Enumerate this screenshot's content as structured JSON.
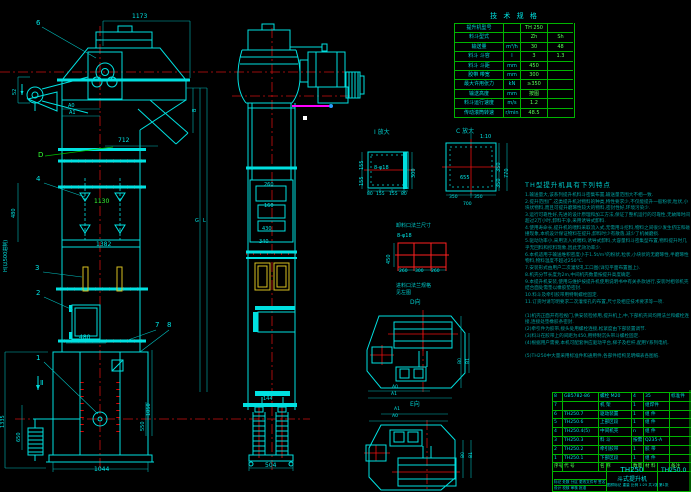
{
  "colors": {
    "background": "#000000",
    "line_cyan": "#00e0e0",
    "dim_cyan": "#00b8b8",
    "centerline_red": "#ff2020",
    "grid_green": "#00b400",
    "text_green": "#5aff5a",
    "note_teal": "#00a0a0",
    "bucket_yellow": "#d8c020",
    "magenta": "#ff00ff"
  },
  "spec": {
    "title": "技 术 规 格",
    "rows": [
      [
        "提升机型号",
        "",
        "TH 250",
        ""
      ],
      [
        "料斗型式",
        "",
        "Zh",
        "Sh"
      ],
      [
        "输送量",
        "m³/h",
        "30",
        "48"
      ],
      [
        "料斗 斗容",
        "l",
        "3",
        "1.3"
      ],
      [
        "料斗 斗距",
        "mm",
        "450",
        ""
      ],
      [
        "胶带 带宽",
        "mm",
        "300",
        ""
      ],
      [
        "最大许用张力",
        "kN",
        "≥350",
        ""
      ],
      [
        "输送高度",
        "mm",
        "按图",
        ""
      ],
      [
        "料斗运行速度",
        "m/s",
        "1.2",
        ""
      ],
      [
        "传动滚筒转速",
        "r/min",
        "48.5",
        ""
      ]
    ]
  },
  "notes": {
    "title": "TH型提升机具有下列特点",
    "lines": [
      "1.输送量大,该系列提升机料斗密集布置,输送量范围大不相一致.",
      "2.提升范围广,这类提升机对物料的种类,特性要求少,不仅能提升一般粉状,粒状,小块状物料,而且可提升磨琢性较大的物料,密封性好,环境污染少.",
      "3.运行可靠性好,先进的设计原理和加工方法,保证了整机运行的可靠性,无故障时间超过2万小时,卸料干净,采用诱导式卸料.",
      "4.使用寿命长,提升机的喂料采取流入式,无需用斗挖料,物料之间很少发生挤压和碰撞现象,本机设计保证物料在提升,卸料时少有散落,减少了机械磨损.",
      "5.驱动功率小,采用流入式喂料,诱导式卸料,大容量料斗密集型布置,物料提升时几乎无回料和挖料现象,因此无效功率少.",
      "6.本机适用于输送堆积密度小于1.5t/m³的粉状,粒状,小块状的无磨琢性,半磨琢性物料,物料温度不超过250℃.",
      "7.安装形式由用户二次灌浆孔工口图(详见平面布置图上).",
      "8.机壳分节长度为2m,中间机壳数量按提升高度确定.",
      "9.本提升机安装,使用与维护按提升机使用说明书中有关条款进行,安装时相邻机壳结合面处需垫以橡胶垫密封.",
      "10.料斗及牵引胶带用特制螺栓固定.",
      "11.订货时请写明要求二次灌浆孔的布置,尺寸及相应技术要求等一项.",
      "",
      "(1)机壳正面开有检视门,供安装检修用,提升机上,中,下部机壳间均用法兰和螺栓连接,连接处垫橡胶条密封.",
      "(2)牵引件为胶带,接头处用螺栓连接,松紧度由下部装置调节.",
      "(3)料斗在胶带上的间距为450,用特制沉头带斗螺栓固定.",
      "(4)根据用户需要,本机可配套供应驱动平台,梯子及栏杆,配用Y系列电机.",
      "",
      "(5)TH250中大量采用标准件和通用件,各部件结构见明细表各图纸."
    ]
  },
  "bom": {
    "header": [
      "序号",
      "代  号",
      "名  称",
      "数量",
      "材  料",
      "备注"
    ],
    "rows": [
      {
        "no": "8",
        "code": "GB5782-86",
        "name": "螺栓 M20",
        "qty": "4",
        "mat": "35",
        "note": "标准件"
      },
      {
        "no": "7",
        "code": "",
        "name": "机 架",
        "qty": "1",
        "mat": "组焊件",
        "note": ""
      },
      {
        "no": "6",
        "code": "TH250.7",
        "name": "驱动装置",
        "qty": "1",
        "mat": "组 件",
        "note": ""
      },
      {
        "no": "5",
        "code": "TH250.6",
        "name": "上部区段",
        "qty": "1",
        "mat": "组 件",
        "note": ""
      },
      {
        "no": "4",
        "code": "TH250.4(5)",
        "name": "中间机壳",
        "qty": "n",
        "mat": "组 件",
        "note": ""
      },
      {
        "no": "3",
        "code": "TH250.3",
        "name": "料 斗",
        "qty": "按需",
        "mat": "Q235-A",
        "note": ""
      },
      {
        "no": "2",
        "code": "TH250.2",
        "name": "牵引胶带",
        "qty": "1",
        "mat": "胶 带",
        "note": ""
      },
      {
        "no": "1",
        "code": "TH250.1",
        "name": "下部区段",
        "qty": "1",
        "mat": "组 件",
        "note": ""
      }
    ]
  },
  "title_block": {
    "model": "TH250",
    "product": "斗式提升机",
    "drawing_no": "TH250.0",
    "sig_row1": "标记 处数 分区 更改文件号 签名 日期",
    "sig_row2": "设计   校核   审核   批准",
    "scale_row": "图样标记    重量    比例 1:25    共1张 第1张"
  },
  "labels": [
    {
      "t": "1173",
      "x": 132,
      "y": 14,
      "c": "#00e5e5",
      "s": 6,
      "r": 0
    },
    {
      "t": "712",
      "x": 118,
      "y": 138,
      "c": "#00e5e5",
      "s": 6,
      "r": 0
    },
    {
      "t": "A0",
      "x": 68,
      "y": 104,
      "c": "#00e5e5",
      "s": 5,
      "r": 0
    },
    {
      "t": "A1",
      "x": 69,
      "y": 111,
      "c": "#00e5e5",
      "s": 5,
      "r": 0
    },
    {
      "t": "52",
      "x": 13,
      "y": 95,
      "c": "#00e5e5",
      "s": 5,
      "r": -90
    },
    {
      "t": "6",
      "x": 36,
      "y": 20,
      "c": "#00e5e5",
      "s": 7,
      "r": 0
    },
    {
      "t": "D",
      "x": 38,
      "y": 152,
      "c": "#33ff33",
      "s": 7,
      "r": 0
    },
    {
      "t": "4",
      "x": 36,
      "y": 176,
      "c": "#00e5e5",
      "s": 7,
      "r": 0
    },
    {
      "t": "480",
      "x": 12,
      "y": 218,
      "c": "#00e5e5",
      "s": 5,
      "r": -90
    },
    {
      "t": "1130",
      "x": 94,
      "y": 199,
      "c": "#33ff33",
      "s": 6,
      "r": 0
    },
    {
      "t": "1382",
      "x": 96,
      "y": 242,
      "c": "#00e5e5",
      "s": 6,
      "r": 0
    },
    {
      "t": "H(以500进制)",
      "x": 4,
      "y": 272,
      "c": "#00e5e5",
      "s": 5,
      "r": -90
    },
    {
      "t": "3",
      "x": 35,
      "y": 265,
      "c": "#00e5e5",
      "s": 7,
      "r": 0
    },
    {
      "t": "2",
      "x": 36,
      "y": 290,
      "c": "#00e5e5",
      "s": 7,
      "r": 0
    },
    {
      "t": "G",
      "x": 195,
      "y": 219,
      "c": "#00e5e5",
      "s": 5,
      "r": 0
    },
    {
      "t": "L",
      "x": 203,
      "y": 219,
      "c": "#00e5e5",
      "s": 5,
      "r": 0
    },
    {
      "t": "7",
      "x": 155,
      "y": 322,
      "c": "#00e5e5",
      "s": 7,
      "r": 0
    },
    {
      "t": "8",
      "x": 167,
      "y": 322,
      "c": "#00e5e5",
      "s": 7,
      "r": 0
    },
    {
      "t": "1",
      "x": 36,
      "y": 355,
      "c": "#00e5e5",
      "s": 7,
      "r": 0
    },
    {
      "t": "480",
      "x": 79,
      "y": 335,
      "c": "#00e5e5",
      "s": 6,
      "r": 0
    },
    {
      "t": "Ⅱ",
      "x": 40,
      "y": 380,
      "c": "#00e5e5",
      "s": 7,
      "r": 0
    },
    {
      "t": "1335",
      "x": 1,
      "y": 428,
      "c": "#00e5e5",
      "s": 5,
      "r": -90
    },
    {
      "t": "650",
      "x": 17,
      "y": 442,
      "c": "#00e5e5",
      "s": 5,
      "r": -90
    },
    {
      "t": "1050",
      "x": 147,
      "y": 416,
      "c": "#00e5e5",
      "s": 5,
      "r": -90
    },
    {
      "t": "550",
      "x": 141,
      "y": 431,
      "c": "#00e5e5",
      "s": 5,
      "r": -90
    },
    {
      "t": "1044",
      "x": 94,
      "y": 467,
      "c": "#00e5e5",
      "s": 6,
      "r": 0
    },
    {
      "t": "B",
      "x": 193,
      "y": 112,
      "c": "#00e5e5",
      "s": 5,
      "r": -90
    },
    {
      "t": "260",
      "x": 264,
      "y": 183,
      "c": "#00e5e5",
      "s": 5,
      "r": 0
    },
    {
      "t": "160",
      "x": 264,
      "y": 204,
      "c": "#00e5e5",
      "s": 5,
      "r": 0
    },
    {
      "t": "430",
      "x": 262,
      "y": 227,
      "c": "#00e5e5",
      "s": 5,
      "r": 0
    },
    {
      "t": "340",
      "x": 259,
      "y": 240,
      "c": "#00e5e5",
      "s": 5,
      "r": 0
    },
    {
      "t": "144",
      "x": 263,
      "y": 397,
      "c": "#00e5e5",
      "s": 5,
      "r": 0
    },
    {
      "t": "504",
      "x": 265,
      "y": 463,
      "c": "#00e5e5",
      "s": 6,
      "r": 0
    },
    {
      "t": "Ⅰ 放大",
      "x": 374,
      "y": 130,
      "c": "#00cccc",
      "s": 6,
      "r": 0
    },
    {
      "t": "155",
      "x": 360,
      "y": 170,
      "c": "#00e5e5",
      "s": 5,
      "r": -90
    },
    {
      "t": "155",
      "x": 360,
      "y": 186,
      "c": "#00e5e5",
      "s": 5,
      "r": -90
    },
    {
      "t": "300",
      "x": 412,
      "y": 178,
      "c": "#00e5e5",
      "s": 5,
      "r": -90
    },
    {
      "t": "8-φ18",
      "x": 374,
      "y": 166,
      "c": "#00e5e5",
      "s": 5,
      "r": 0
    },
    {
      "t": "80",
      "x": 367,
      "y": 193,
      "c": "#00e5e5",
      "s": 4.5,
      "r": 0
    },
    {
      "t": "155",
      "x": 376,
      "y": 193,
      "c": "#00e5e5",
      "s": 4.5,
      "r": 0
    },
    {
      "t": "155",
      "x": 389,
      "y": 193,
      "c": "#00e5e5",
      "s": 4.5,
      "r": 0
    },
    {
      "t": "80",
      "x": 401,
      "y": 193,
      "c": "#00e5e5",
      "s": 4.5,
      "r": 0
    },
    {
      "t": "C 放大",
      "x": 456,
      "y": 129,
      "c": "#00cccc",
      "s": 6,
      "r": 0
    },
    {
      "t": "1:10",
      "x": 480,
      "y": 135,
      "c": "#00e5e5",
      "s": 5,
      "r": 0
    },
    {
      "t": "655",
      "x": 460,
      "y": 176,
      "c": "#00e5e5",
      "s": 5,
      "r": 0
    },
    {
      "t": "350",
      "x": 497,
      "y": 172,
      "c": "#00e5e5",
      "s": 5,
      "r": -90
    },
    {
      "t": "350",
      "x": 497,
      "y": 188,
      "c": "#00e5e5",
      "s": 5,
      "r": -90
    },
    {
      "t": "770",
      "x": 505,
      "y": 178,
      "c": "#00e5e5",
      "s": 5,
      "r": -90
    },
    {
      "t": "350",
      "x": 449,
      "y": 196,
      "c": "#00e5e5",
      "s": 4.5,
      "r": 0
    },
    {
      "t": "350",
      "x": 474,
      "y": 196,
      "c": "#00e5e5",
      "s": 4.5,
      "r": 0
    },
    {
      "t": "700",
      "x": 463,
      "y": 203,
      "c": "#00e5e5",
      "s": 4.5,
      "r": 0
    },
    {
      "t": "卸料口法兰尺寸",
      "x": 396,
      "y": 224,
      "c": "#00cccc",
      "s": 5,
      "r": 0
    },
    {
      "t": "8-φ18",
      "x": 397,
      "y": 234,
      "c": "#00e5e5",
      "s": 5,
      "r": 0
    },
    {
      "t": "450",
      "x": 387,
      "y": 264,
      "c": "#00e5e5",
      "s": 5,
      "r": -90
    },
    {
      "t": "260",
      "x": 399,
      "y": 270,
      "c": "#00e5e5",
      "s": 4.5,
      "r": 0
    },
    {
      "t": "300",
      "x": 415,
      "y": 270,
      "c": "#00e5e5",
      "s": 4.5,
      "r": 0
    },
    {
      "t": "260",
      "x": 431,
      "y": 270,
      "c": "#00e5e5",
      "s": 4.5,
      "r": 0
    },
    {
      "t": "进料口法兰规格",
      "x": 396,
      "y": 284,
      "c": "#00cccc",
      "s": 5,
      "r": 0
    },
    {
      "t": "见左图",
      "x": 396,
      "y": 291,
      "c": "#00cccc",
      "s": 5,
      "r": 0
    },
    {
      "t": "D向",
      "x": 410,
      "y": 300,
      "c": "#00cccc",
      "s": 6,
      "r": 0
    },
    {
      "t": "B0",
      "x": 459,
      "y": 364,
      "c": "#00e5e5",
      "s": 4.5,
      "r": -90
    },
    {
      "t": "B1",
      "x": 467,
      "y": 364,
      "c": "#00e5e5",
      "s": 4.5,
      "r": -90
    },
    {
      "t": "A0",
      "x": 392,
      "y": 386,
      "c": "#00e5e5",
      "s": 4.5,
      "r": 0
    },
    {
      "t": "A1",
      "x": 391,
      "y": 393,
      "c": "#00e5e5",
      "s": 4.5,
      "r": 0
    },
    {
      "t": "E向",
      "x": 410,
      "y": 402,
      "c": "#00cccc",
      "s": 6,
      "r": 0
    },
    {
      "t": "A1",
      "x": 394,
      "y": 408,
      "c": "#00e5e5",
      "s": 4.5,
      "r": 0
    },
    {
      "t": "A0",
      "x": 392,
      "y": 415,
      "c": "#00e5e5",
      "s": 4.5,
      "r": 0
    },
    {
      "t": "B0",
      "x": 462,
      "y": 458,
      "c": "#00e5e5",
      "s": 4.5,
      "r": -90
    },
    {
      "t": "B1",
      "x": 470,
      "y": 458,
      "c": "#00e5e5",
      "s": 4.5,
      "r": -90
    }
  ]
}
